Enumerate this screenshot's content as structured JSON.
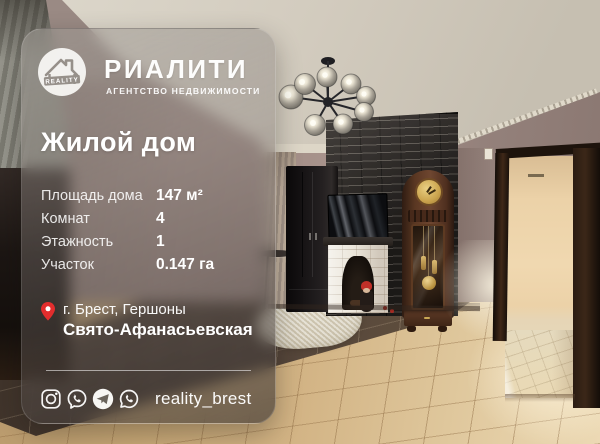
{
  "brand": {
    "name": "РИАЛИТИ",
    "tagline": "АГЕНТСТВО НЕДВИЖИМОСТИ",
    "logo_text": "REALITY"
  },
  "listing": {
    "title": "Жилой дом",
    "details": [
      {
        "label": "Площадь дома",
        "value": "147 м²"
      },
      {
        "label": "Комнат",
        "value": "4"
      },
      {
        "label": "Этажность",
        "value": "1"
      },
      {
        "label": "Участок",
        "value": "0.147 га"
      }
    ],
    "location": {
      "line1": "г. Брест, Гершоны",
      "line2": "Свято-Афанасьевская"
    }
  },
  "footer": {
    "handle": "reality_brest",
    "social_icons": [
      "instagram-icon",
      "viber-icon",
      "telegram-icon",
      "whatsapp-icon"
    ]
  },
  "colors": {
    "accent_red": "#e22d2d",
    "card_text": "#ffffff"
  }
}
